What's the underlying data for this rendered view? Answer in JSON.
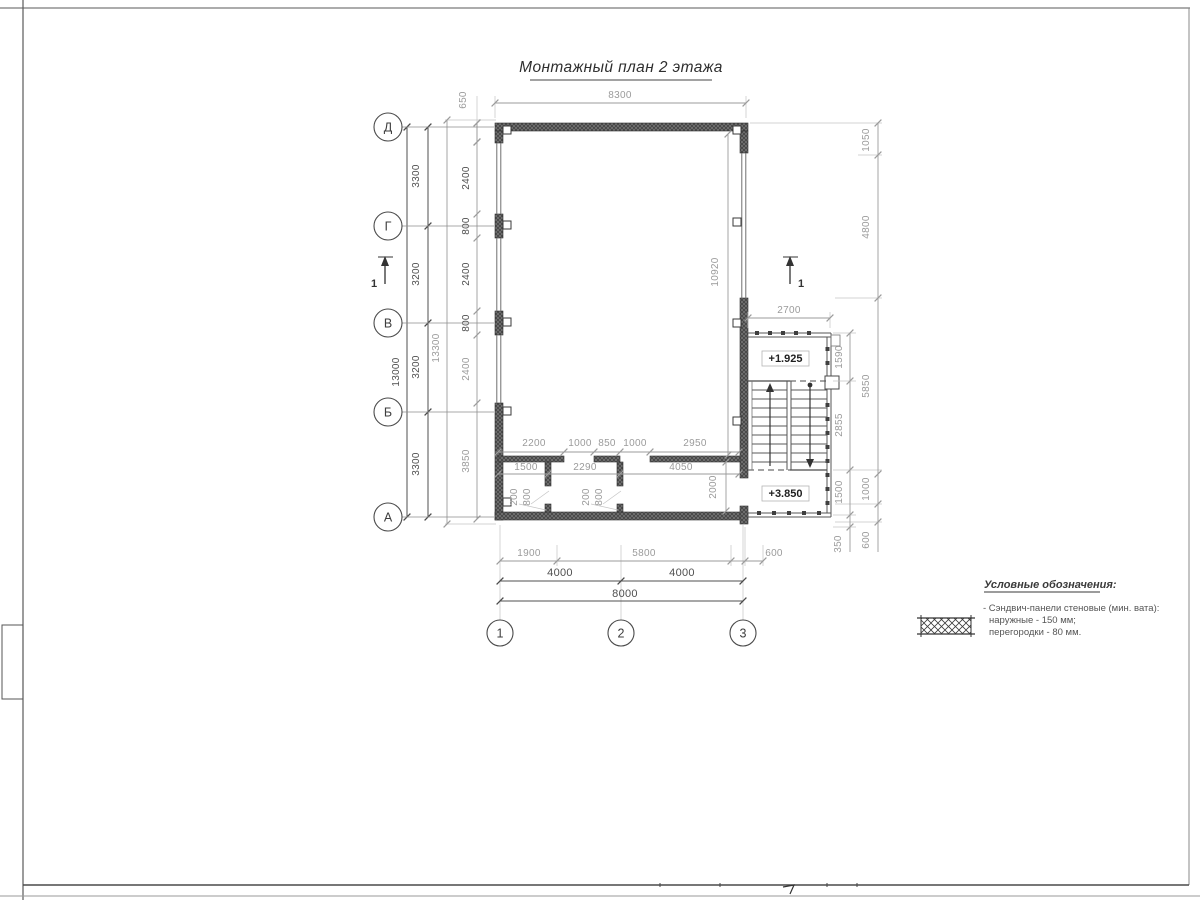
{
  "title": {
    "text": "Монтажный план 2 этажа"
  },
  "axes": {
    "left": [
      "Д",
      "Г",
      "В",
      "Б",
      "А"
    ],
    "bottom": [
      "1",
      "2",
      "3"
    ]
  },
  "section_marks": {
    "left": "1",
    "right": "1"
  },
  "levels": {
    "upper": "+1.925",
    "lower": "+3.850"
  },
  "dims": {
    "top_overall": "8300",
    "top_offset": "650",
    "left_overall": "13000",
    "left_outer": "13300",
    "left_spans": [
      "3300",
      "3200",
      "3200",
      "3300"
    ],
    "left_wall": [
      "2400",
      "800",
      "2400",
      "800",
      "2400",
      "3850"
    ],
    "hall_height": "10920",
    "right_room": "2000",
    "part_row1": [
      "2200",
      "1000",
      "850",
      "1000",
      "2950"
    ],
    "part_row2": [
      "1500",
      "2290",
      "4050"
    ],
    "door1": [
      "200",
      "800"
    ],
    "door2": [
      "200",
      "800"
    ],
    "stair_width": "2700",
    "stair_col": [
      "1590",
      "2855",
      "1500",
      "350"
    ],
    "right_col": [
      "1050",
      "4800",
      "5850",
      "1000",
      "600"
    ],
    "bottom_row1": [
      "1900",
      "5800",
      "600"
    ],
    "bottom_row2": [
      "4000",
      "4000"
    ],
    "bottom_overall": "8000"
  },
  "legend": {
    "header": "Условные обозначения:",
    "item_line1": "- Сэндвич-панели стеновые (мин. вата):",
    "item_line2": "наружные - 150 мм;",
    "item_line3": "перегородки - 80 мм."
  },
  "colors": {
    "line_dark": "#4a4a4a",
    "line_grey": "#9b9b9b",
    "wall_fill": "#434343",
    "paper": "#ffffff"
  }
}
